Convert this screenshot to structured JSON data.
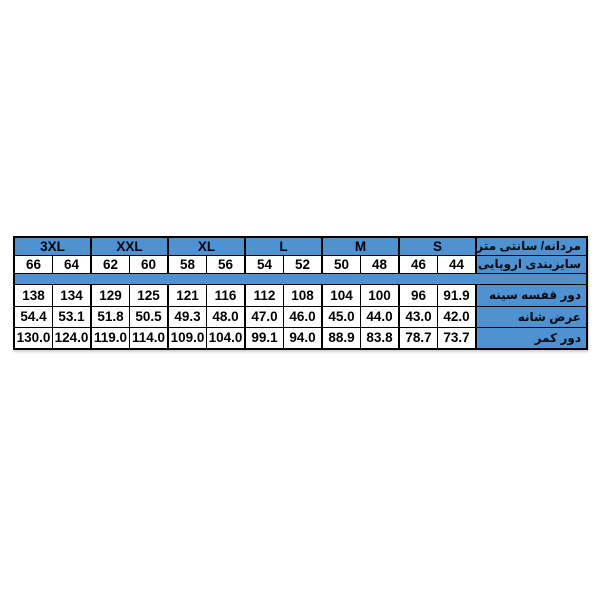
{
  "colors": {
    "header_fill": "#4E92D2",
    "border": "#000000",
    "number_text": "#000000",
    "label_text": "#03080f",
    "cell_background": "#ffffff",
    "page_background": "#ffffff"
  },
  "chart_data": {
    "type": "table",
    "direction": "rtl",
    "corner_label": "مردانه/ سانتی متر",
    "size_groups": [
      "3XL",
      "XXL",
      "XL",
      "L",
      "M",
      "S"
    ],
    "rows": [
      {
        "label": "سایزبندی اروپایی",
        "values": [
          "66",
          "64",
          "62",
          "60",
          "58",
          "56",
          "54",
          "52",
          "50",
          "48",
          "46",
          "44"
        ]
      },
      {
        "label": "دور قفسه سینه",
        "values": [
          "138",
          "134",
          "129",
          "125",
          "121",
          "116",
          "112",
          "108",
          "104",
          "100",
          "96",
          "91.9"
        ]
      },
      {
        "label": "عرض شانه",
        "values": [
          "54.4",
          "53.1",
          "51.8",
          "50.5",
          "49.3",
          "48.0",
          "47.0",
          "46.0",
          "45.0",
          "44.0",
          "43.0",
          "42.0"
        ]
      },
      {
        "label": "دور کمر",
        "values": [
          "130.0",
          "124.0",
          "119.0",
          "114.0",
          "109.0",
          "104.0",
          "99.1",
          "94.0",
          "88.9",
          "83.8",
          "78.7",
          "73.7"
        ]
      }
    ],
    "layout_hints": {
      "grid": "on",
      "label_column_side": "right",
      "separator_row_after_row_index": 0
    }
  }
}
